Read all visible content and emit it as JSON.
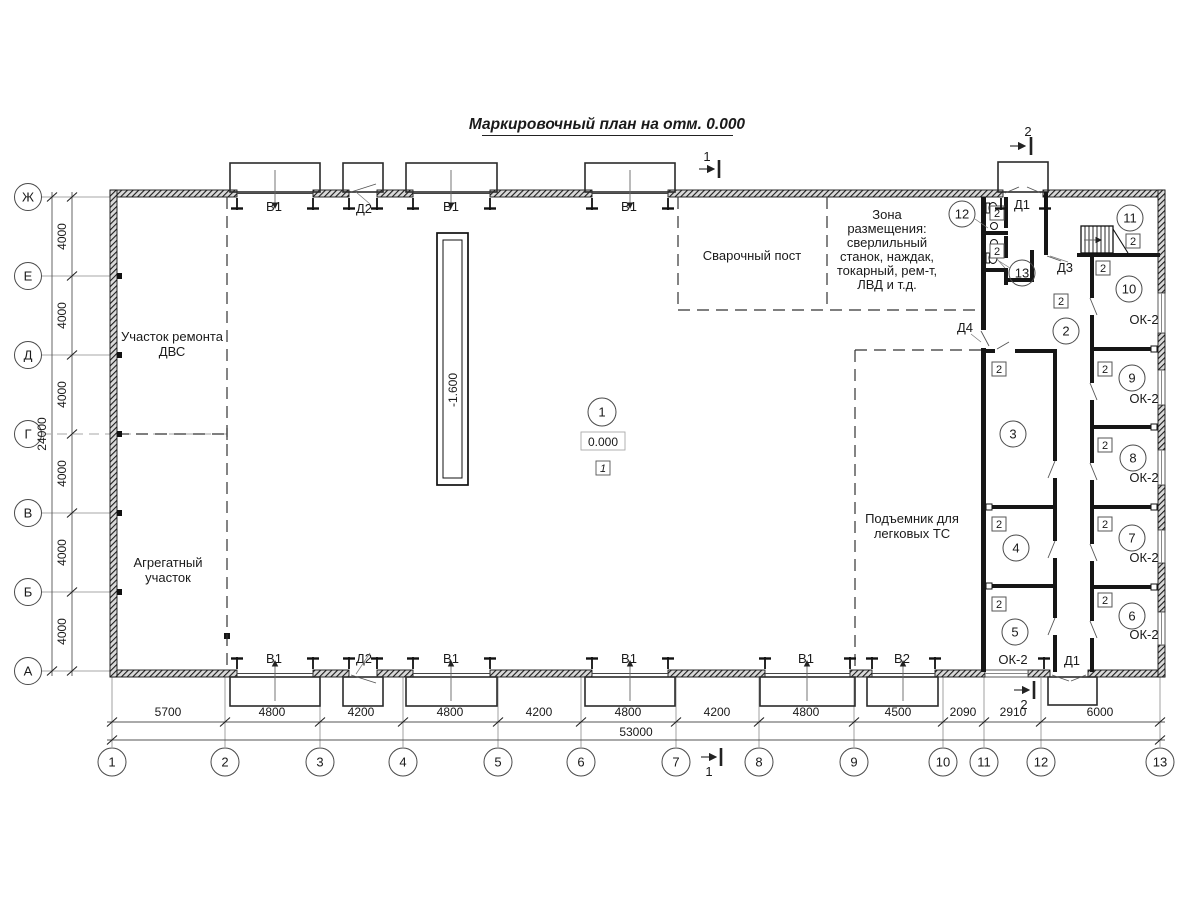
{
  "title": "Маркировочный план на отм. 0.000",
  "axes": {
    "horizontal": {
      "labels": [
        "1",
        "2",
        "3",
        "4",
        "5",
        "6",
        "7",
        "8",
        "9",
        "10",
        "11",
        "12",
        "13"
      ],
      "dims": [
        "5700",
        "4800",
        "4200",
        "4800",
        "4200",
        "4800",
        "4200",
        "4800",
        "4500",
        "2090",
        "2910",
        "6000"
      ],
      "total": "53000"
    },
    "vertical": {
      "labels": [
        "Ж",
        "Е",
        "Д",
        "Г",
        "В",
        "Б",
        "А"
      ],
      "dims": [
        "4000",
        "4000",
        "4000",
        "4000",
        "4000",
        "4000"
      ],
      "total": "24000"
    }
  },
  "zones": {
    "engine_repair": [
      "Участок ремонта",
      "ДВС"
    ],
    "aggregate": [
      "Агрегатный",
      "участок"
    ],
    "welding": "Сварочный пост",
    "equipment": [
      "Зона",
      "размещения:",
      "сверлильный",
      "станок, наждак,",
      "токарный, рем-т,",
      "ЛВД и т.д."
    ],
    "lift": [
      "Подъемник для",
      "легковых ТС"
    ]
  },
  "rooms": [
    "1",
    "2",
    "3",
    "4",
    "5",
    "6",
    "7",
    "8",
    "9",
    "10",
    "11",
    "12",
    "13"
  ],
  "marks": {
    "pit_level": "-1.600",
    "floor_level": "0.000",
    "floor_type_1": "1",
    "floor_type_2": "2"
  },
  "openings": {
    "gate1": "В1",
    "gate2": "В2",
    "door1": "Д1",
    "door2": "Д2",
    "door3": "Д3",
    "door4": "Д4",
    "window": "ОК-2"
  },
  "sections": {
    "s1": "1",
    "s2": "2"
  }
}
